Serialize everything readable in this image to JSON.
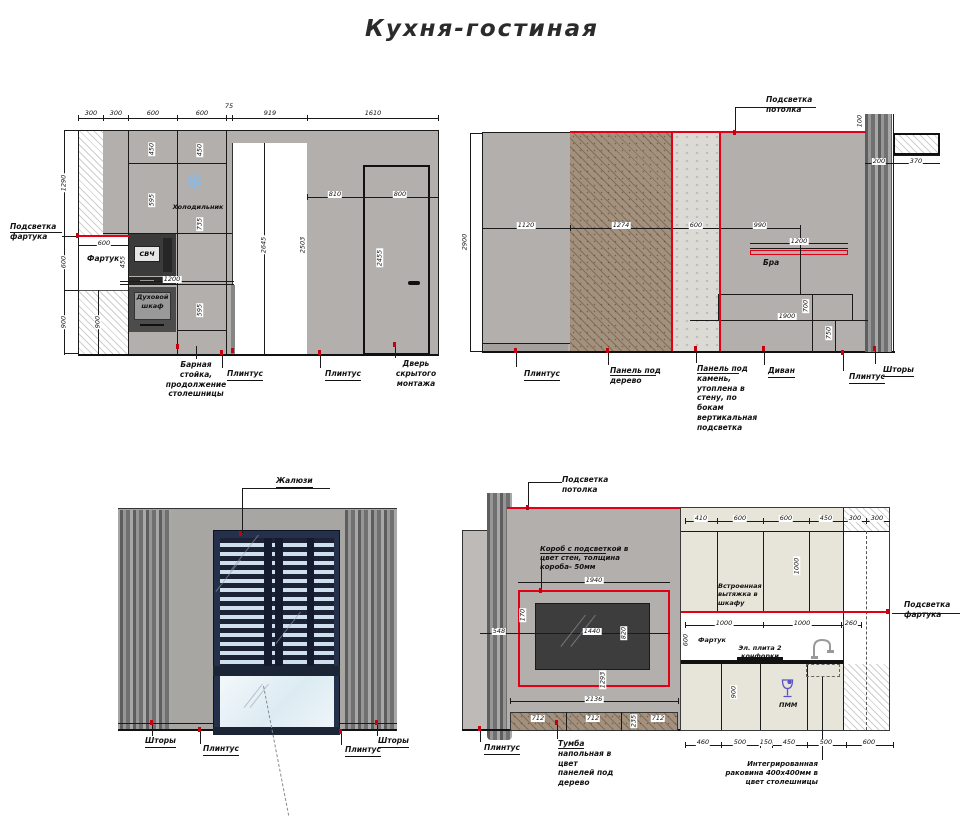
{
  "title": "Кухня-гостиная",
  "colors": {
    "accent_red": "#e30016",
    "marker_red": "#c40011",
    "wall_gray": "#b2afac",
    "wood": "#a3917d",
    "stone": "#dbdad5",
    "cabinet_beige": "#e7e4d9",
    "blind_navy": "#1c2336",
    "icon_blue": "#5a52c8",
    "fridge_icon_blue": "#8ab9e4"
  },
  "e1": {
    "top_dims": [
      "300",
      "300",
      "600",
      "600",
      "75",
      "919",
      "1610"
    ],
    "left_dims": [
      "1290",
      "600",
      "900"
    ],
    "inner_dims": {
      "fartuk_w": "600",
      "bar_h": "1200",
      "svch_h": "455",
      "cab1": "450",
      "cab2": "595",
      "fr1": "450",
      "fr2": "735",
      "oven": "595",
      "bottom": "900"
    },
    "opening_h": "2645",
    "door_dims": {
      "w1": "810",
      "w2": "800",
      "h1": "2503",
      "h2": "2455"
    },
    "labels": {
      "backlight": "Подсветка\nфартука",
      "fartuk": "Фартук",
      "fridge": "Холодильник",
      "svch": "СВЧ",
      "oven": "Духовой\nшкаф",
      "bar": "Барная\nстойка,\nпродолжение\nстолешницы",
      "plinth1": "Плинтус",
      "plinth2": "Плинтус",
      "door": "Дверь\nскрытого\nмонтажа"
    }
  },
  "e2": {
    "dims": {
      "w1": "1120",
      "w2": "1274",
      "w3": "600",
      "w4": "990",
      "sconce": "1200",
      "height": "2900",
      "r1": "200",
      "r2": "370",
      "r3": "100",
      "sofa_w": "1900",
      "sofa_h1": "700",
      "sofa_h2": "750"
    },
    "labels": {
      "ceiling": "Подсветка\nпотолка",
      "sconce": "Бра",
      "plinth1": "Плинтус",
      "wood": "Панель под\nдерево",
      "stone": "Панель под\nкамень,\nутоплена в\nстену, по\nбокам\nвертикальная\nподсветка",
      "sofa": "Диван",
      "plinth2": "Плинтус",
      "curtains": "Шторы"
    }
  },
  "e3": {
    "labels": {
      "blinds": "Жалюзи",
      "curtains_l": "Шторы",
      "plinth_l": "Плинтус",
      "plinth_r": "Плинтус",
      "curtains_r": "Шторы"
    }
  },
  "e4": {
    "top_dims": [
      "410",
      "600",
      "600",
      "450",
      "300",
      "300"
    ],
    "mid_dims": [
      "1000",
      "1000",
      "260"
    ],
    "bottom_dims": [
      "460",
      "500",
      "150",
      "450",
      "500",
      "600"
    ],
    "left_dims": {
      "box_w": "1940",
      "off": "548",
      "tv_w": "1440",
      "gap": "170",
      "tv_h": "820",
      "low": "1293",
      "total": "2136",
      "c1": "712",
      "c2": "712",
      "c3": "235",
      "c4": "712"
    },
    "right_dims": {
      "apron_h": "600",
      "upper_h": "1000",
      "lower_h": "900"
    },
    "labels": {
      "ceiling": "Подсветка\nпотолка",
      "box": "Короб с подсветкой в\nцвет стен, толщина\nкороба- 50мм",
      "hood": "Встроенная\nвытяжка в\nшкафу",
      "apron_light": "Подсветка\nфартука",
      "fartuk": "Фартук",
      "stove": "Эл. плита 2\nконфорки",
      "pmm": "ПММ",
      "plinth": "Плинтус",
      "tumba": "Тумба\nнапольная в\nцвет\nпанелей под\nдерево",
      "sink": "Интегрированная\nраковина 400х400мм в\nцвет столешницы"
    }
  }
}
